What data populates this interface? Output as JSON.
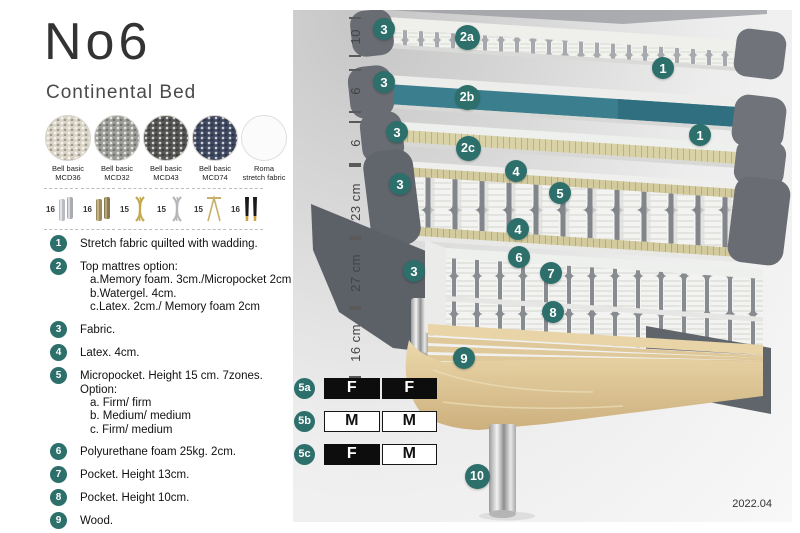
{
  "header": {
    "title": "No6",
    "subtitle": "Continental Bed"
  },
  "fabrics": [
    {
      "name": "Bell basic",
      "code": "MCD36",
      "color": "#d9d4c6"
    },
    {
      "name": "Bell basic",
      "code": "MCD32",
      "color": "#9c9c98"
    },
    {
      "name": "Bell basic",
      "code": "MCD43",
      "color": "#565654"
    },
    {
      "name": "Bell basic",
      "code": "MCD74",
      "color": "#3f4961"
    },
    {
      "name": "Roma",
      "code": "stretch fabric",
      "color": "#fbfbfb"
    }
  ],
  "leg_options": [
    {
      "height": "16",
      "type": "cylinder-silver"
    },
    {
      "height": "16",
      "type": "cylinder-bronze"
    },
    {
      "height": "15",
      "type": "twist-gold"
    },
    {
      "height": "15",
      "type": "twist-silver"
    },
    {
      "height": "15",
      "type": "hairpin-gold"
    },
    {
      "height": "16",
      "type": "tapered-black-gold"
    }
  ],
  "features": [
    {
      "num": "1",
      "text": "Stretch fabric quilted with wadding.",
      "sub": []
    },
    {
      "num": "2",
      "text": "Top mattres option:",
      "sub": [
        "a.Memory foam. 3cm./Micropocket 2cm",
        "b.Watergel. 4cm.",
        "c.Latex. 2cm./ Memory foam 2cm"
      ]
    },
    {
      "num": "3",
      "text": "Fabric.",
      "sub": []
    },
    {
      "num": "4",
      "text": "Latex. 4cm.",
      "sub": []
    },
    {
      "num": "5",
      "text": "Micropocket. Height 15 cm. 7zones. Option:",
      "sub": [
        "a. Firm/ firm",
        "b. Medium/ medium",
        "c. Firm/ medium"
      ]
    },
    {
      "num": "6",
      "text": "Polyurethane foam 25kg. 2cm.",
      "sub": []
    },
    {
      "num": "7",
      "text": "Pocket. Height 13cm.",
      "sub": []
    },
    {
      "num": "8",
      "text": "Pocket. Height 10cm.",
      "sub": []
    },
    {
      "num": "9",
      "text": "Wood.",
      "sub": []
    },
    {
      "num": "10",
      "text": "Metal leg. Height 16cm.",
      "sub": []
    }
  ],
  "diagram": {
    "ruler_labels": [
      "10",
      "6",
      "6",
      "23 cm",
      "27 cm",
      "16 cm"
    ],
    "callouts": [
      "3",
      "2a",
      "1",
      "3",
      "2b",
      "3",
      "1",
      "2c",
      "3",
      "4",
      "5",
      "4",
      "6",
      "7",
      "8",
      "3",
      "9",
      "10"
    ],
    "firmness_rows": [
      {
        "label": "5a",
        "cells": [
          {
            "text": "F",
            "variant": "dark"
          },
          {
            "text": "F",
            "variant": "dark"
          }
        ]
      },
      {
        "label": "5b",
        "cells": [
          {
            "text": "M",
            "variant": "light"
          },
          {
            "text": "M",
            "variant": "light"
          }
        ]
      },
      {
        "label": "5c",
        "cells": [
          {
            "text": "F",
            "variant": "dark"
          },
          {
            "text": "M",
            "variant": "light"
          }
        ]
      }
    ],
    "version": "2022.04",
    "colors": {
      "badge_teal": "#2d6f6b",
      "layer_teal": "#3b7f8e",
      "wood": "#dcc091"
    }
  }
}
